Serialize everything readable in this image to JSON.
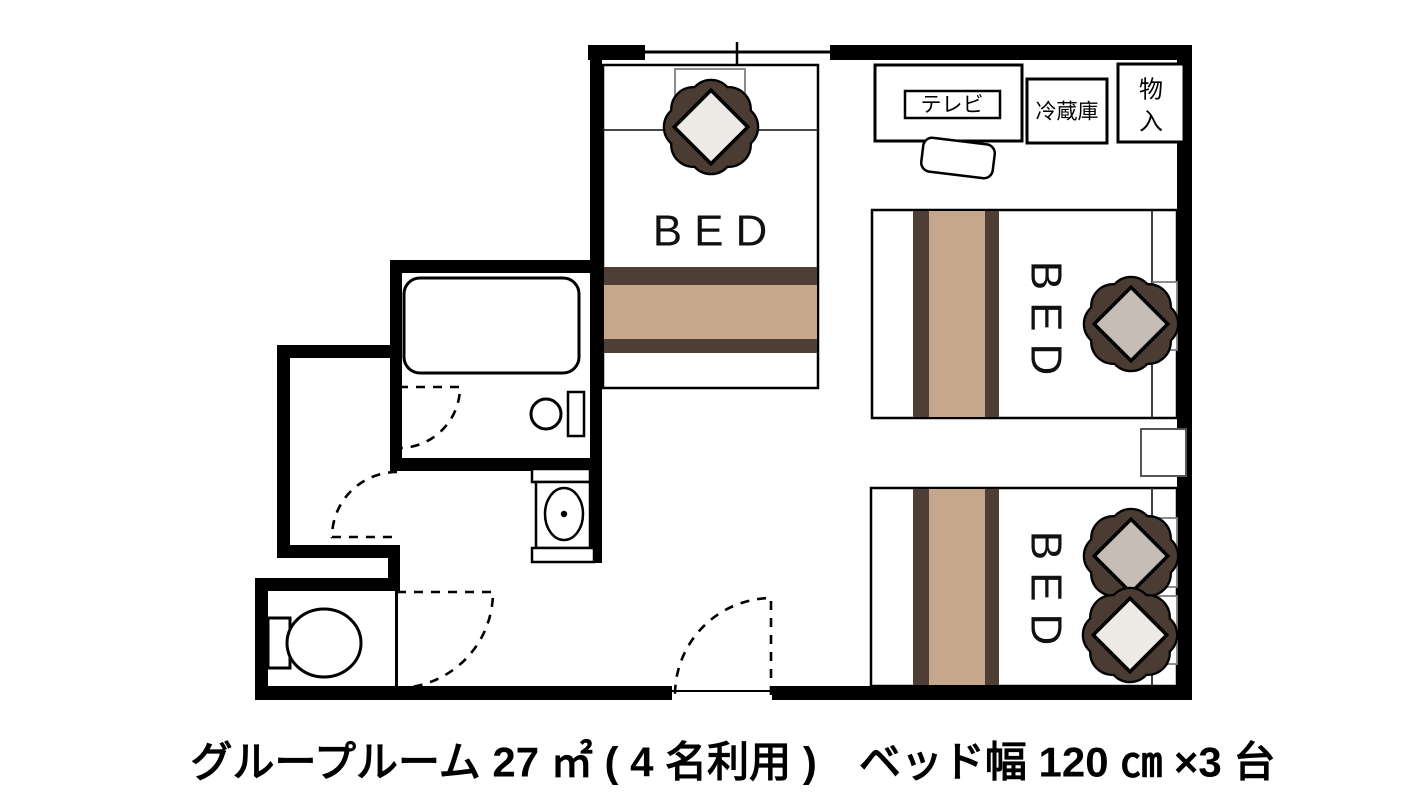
{
  "plan": {
    "caption": "グループルーム 27 ㎡ ( 4 名利用 )　ベッド幅 120 ㎝ ×3 台",
    "labels": {
      "tv": "テレビ",
      "fridge": "冷蔵庫",
      "storage_line1": "物",
      "storage_line2": "入"
    },
    "beds": [
      {
        "label": "BED"
      },
      {
        "label": "BED"
      },
      {
        "label": "BED"
      }
    ],
    "colors": {
      "wall": "#000000",
      "runner_dark": "#4e3e36",
      "runner_tan": "#c7a78c",
      "petal_dark": "#4a3b33",
      "cushion_white": "#edeae6",
      "cushion_gray": "#c5bdb6"
    }
  }
}
